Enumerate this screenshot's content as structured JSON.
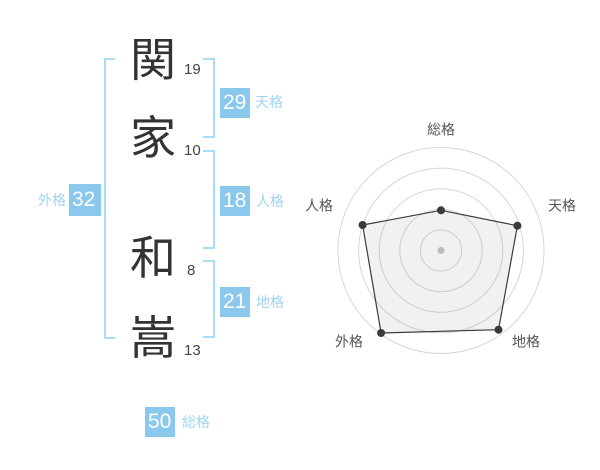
{
  "name_display": {
    "characters": [
      {
        "char": "関",
        "strokes": "19",
        "part": "surname"
      },
      {
        "char": "家",
        "strokes": "10",
        "part": "surname"
      },
      {
        "char": "和",
        "strokes": "8",
        "part": "given"
      },
      {
        "char": "嵩",
        "strokes": "13",
        "part": "given"
      }
    ],
    "kaku_badges": {
      "tenkaku": {
        "value": "29",
        "label": "天格"
      },
      "jinkaku": {
        "value": "18",
        "label": "人格"
      },
      "chikaku": {
        "value": "21",
        "label": "地格"
      },
      "gaikaku": {
        "value": "32",
        "label": "外格"
      },
      "soukaku": {
        "value": "50",
        "label": "総格"
      }
    }
  },
  "colors": {
    "badge_blue": "#8ac8ee",
    "label_blue": "#a0d4f3",
    "bracket_blue": "#a8dcf7",
    "kanji_dark": "#333333",
    "stroke_number_gray": "#444444"
  },
  "chart_data": {
    "type": "radar",
    "title": "",
    "axes": [
      "総格",
      "天格",
      "地格",
      "外格",
      "人格"
    ],
    "values_relative": [
      0.39,
      0.78,
      0.95,
      0.99,
      0.8
    ],
    "value_scale": "fraction of outer ring radius (0-1)",
    "rings": 5,
    "grid_shape": "circular",
    "legend": "none",
    "ring_color": "#d6d6d6",
    "stroke_color": "#3a3a3a",
    "fill_color": "rgba(120,120,120,0.10)",
    "point_color": "#3a3a3a",
    "center_dot_color": "#c4c4c4",
    "label_color": "#555555"
  }
}
